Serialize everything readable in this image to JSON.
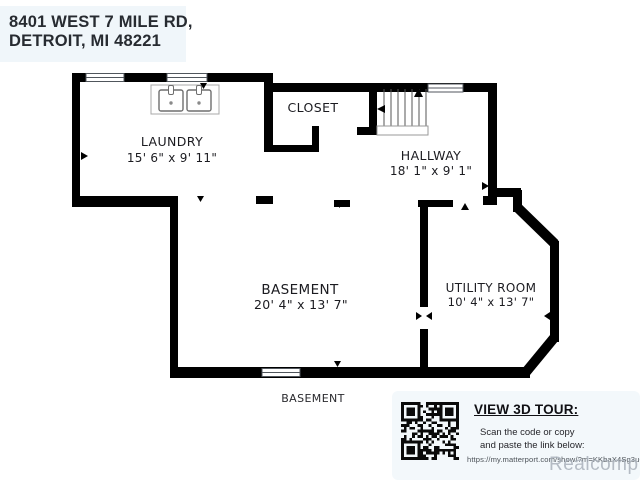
{
  "address": {
    "line1": "8401 WEST 7 MILE RD,",
    "line2": "DETROIT, MI 48221"
  },
  "rooms": [
    {
      "name": "LAUNDRY",
      "dimensions": "15' 6\" x 9' 11\""
    },
    {
      "name": "CLOSET",
      "dimensions": ""
    },
    {
      "name": "HALLWAY",
      "dimensions": "18' 1\" x 9' 1\""
    },
    {
      "name": "BASEMENT",
      "dimensions": "20' 4\" x 13' 7\""
    },
    {
      "name": "UTILITY ROOM",
      "dimensions": "10' 4\" x 13' 7\""
    }
  ],
  "floor_label": "BASEMENT",
  "tour_panel": {
    "title": "VIEW 3D TOUR:",
    "instructions_line1": "Scan the code or copy",
    "instructions_line2": "and paste the link below:",
    "url": "https://my.matterport.com/show/?m=KKbaX4Sg3uQ"
  },
  "watermark": "Realcomp",
  "fixtures": [
    "double-sink",
    "staircase",
    "windows",
    "door-arrows"
  ],
  "colors": {
    "wall": "#000000",
    "label_text": "#1b1b20",
    "address_bg": "#f0f6fa",
    "panel_bg": "#f3f8fb",
    "watermark": "#a8b0ba",
    "background": "#ffffff"
  }
}
